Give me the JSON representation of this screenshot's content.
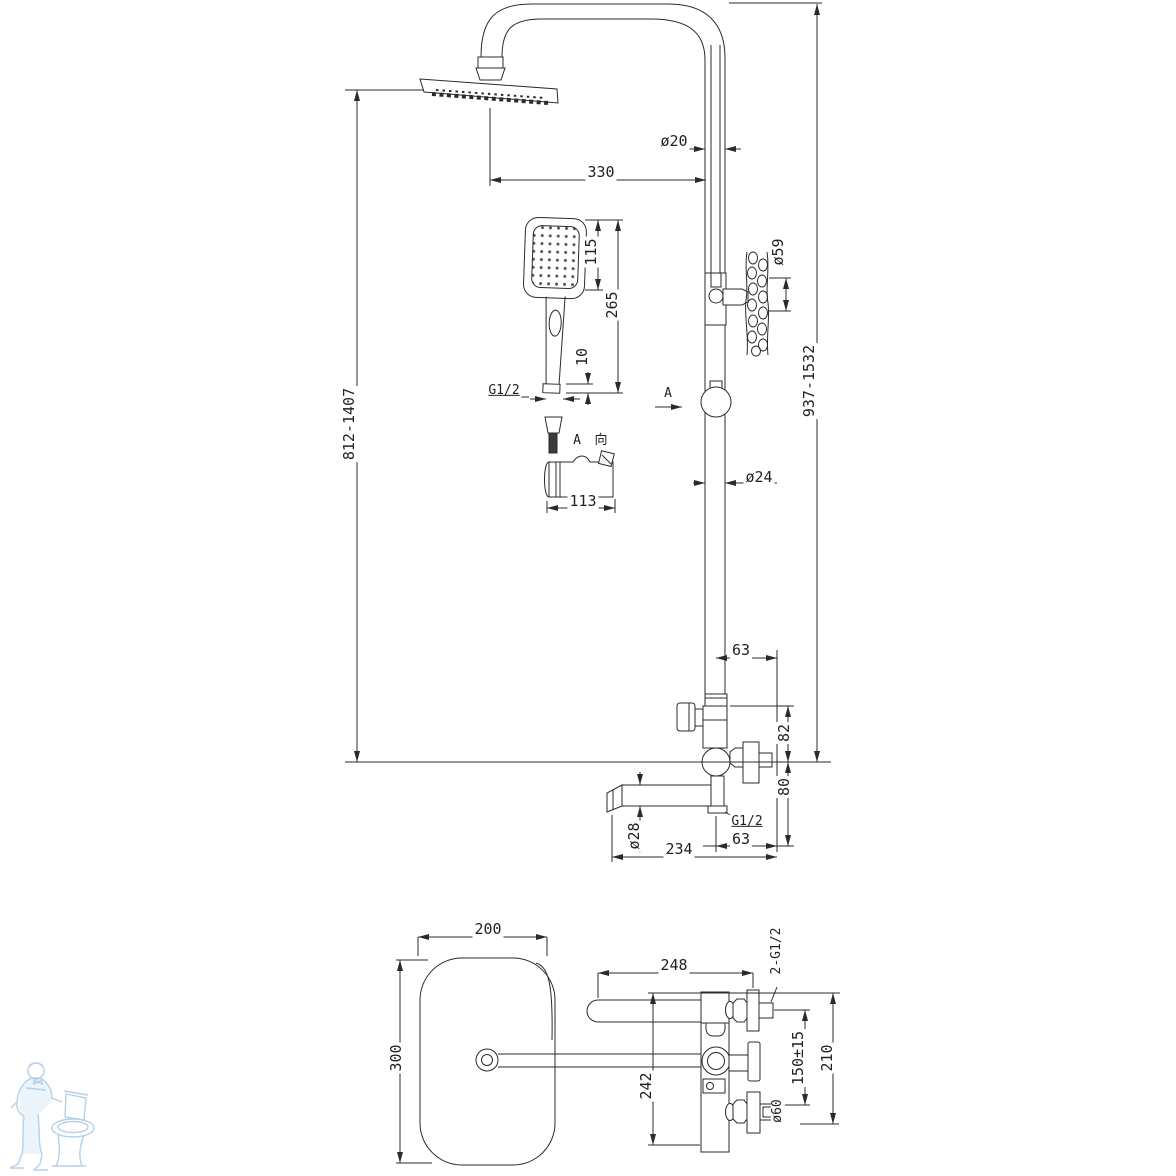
{
  "colors": {
    "background": "#ffffff",
    "line": "#2b2b2b",
    "watermark": "#b5d0e8"
  },
  "drawing": {
    "kind": "technical-dimension-drawing",
    "subject": "shower column system with rain head, hand shower and bath spout"
  },
  "watermark": {
    "icon": "plumber-with-toilet-illustration",
    "color": "#b5d0e8"
  },
  "annotations": [
    {
      "text": "330"
    },
    {
      "text": "ø20"
    },
    {
      "text": "115"
    },
    {
      "text": "265"
    },
    {
      "text": "10"
    },
    {
      "text": "G1/2"
    },
    {
      "text": "ø59"
    },
    {
      "text": "937-1532"
    },
    {
      "text": "812-1407"
    },
    {
      "text": "A"
    },
    {
      "text": "A"
    },
    {
      "text": "向"
    },
    {
      "text": "113"
    },
    {
      "text": "ø24"
    },
    {
      "text": "63"
    },
    {
      "text": "82"
    },
    {
      "text": "80"
    },
    {
      "text": "G1/2"
    },
    {
      "text": "63"
    },
    {
      "text": "234"
    },
    {
      "text": "ø28"
    },
    {
      "text": "200"
    },
    {
      "text": "300"
    },
    {
      "text": "248"
    },
    {
      "text": "242"
    },
    {
      "text": "2-G1/2"
    },
    {
      "text": "150±15"
    },
    {
      "text": "210"
    },
    {
      "text": "ø60"
    }
  ]
}
